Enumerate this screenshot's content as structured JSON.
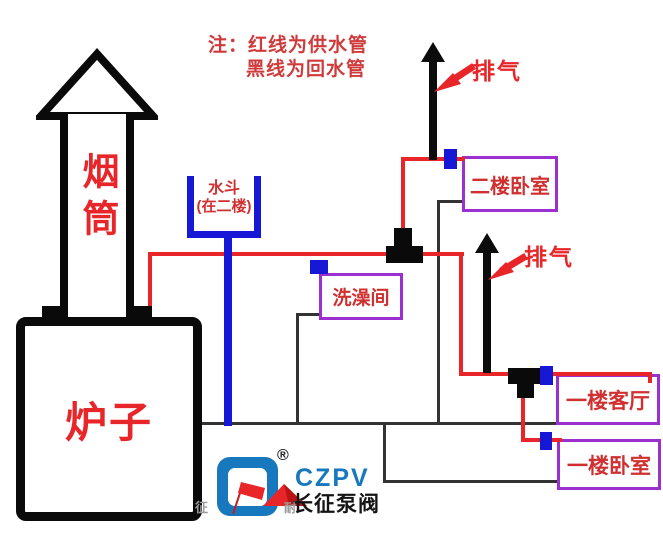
{
  "note": {
    "line1": "注：红线为供水管",
    "line2": "黑线为回水管"
  },
  "labels": {
    "chimney": "烟筒",
    "stove": "炉子",
    "bucket_line1": "水斗",
    "bucket_line2": "(在二楼)",
    "exhaust_top": "排气",
    "exhaust_mid": "排气"
  },
  "rooms": {
    "bedroom_2f": "二楼卧室",
    "bathroom": "洗澡间",
    "living_1f": "一楼客厅",
    "bedroom_1f": "一楼卧室"
  },
  "logo": {
    "registered_mark": "®",
    "acronym": "CZPV",
    "brand_name": "长征泵阀",
    "watermark_left": "征",
    "watermark_right": "耐"
  },
  "colors": {
    "supply_line": "#e8262a",
    "return_line": "#333333",
    "valve_blue": "#1717d6",
    "room_border": "#9b2fd0",
    "logo_blue": "#1778be"
  }
}
